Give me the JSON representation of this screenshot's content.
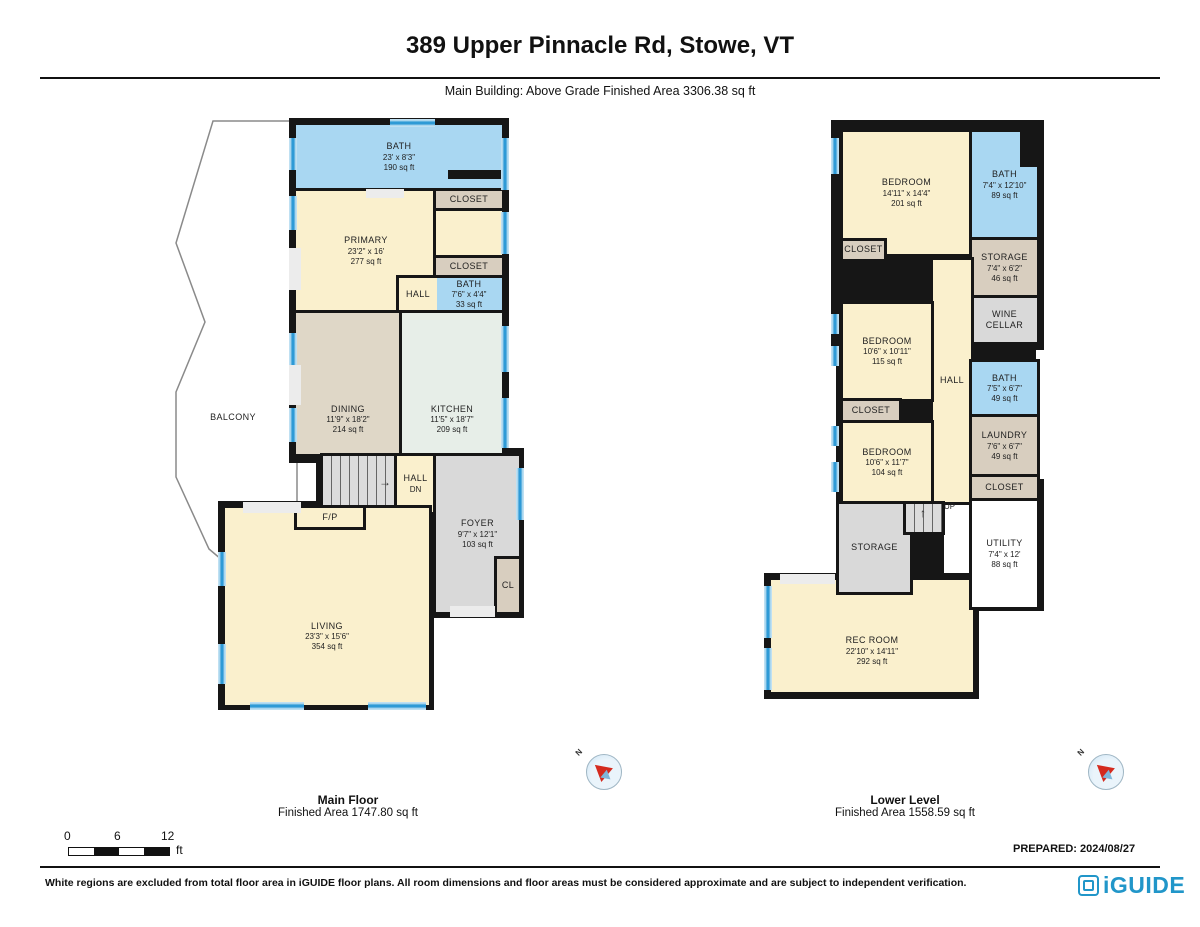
{
  "header": {
    "title": "389 Upper Pinnacle Rd, Stowe, VT",
    "subtitle": "Main Building: Above Grade Finished Area 3306.38 sq ft"
  },
  "floors": {
    "main": {
      "label": "Main Floor",
      "area_label": "Finished Area 1747.80 sq ft",
      "rooms": {
        "bath_top": {
          "name": "BATH",
          "dims": "23' x 8'3\"",
          "area": "190 sq ft"
        },
        "primary": {
          "name": "PRIMARY",
          "dims": "23'2\" x 16'",
          "area": "277 sq ft"
        },
        "closet1": {
          "name": "CLOSET"
        },
        "closet2": {
          "name": "CLOSET"
        },
        "bath_small": {
          "name": "BATH",
          "dims": "7'6\" x 4'4\"",
          "area": "33 sq ft"
        },
        "hall_upper": {
          "name": "HALL"
        },
        "dining": {
          "name": "DINING",
          "dims": "11'9\" x 18'2\"",
          "area": "214 sq ft"
        },
        "kitchen": {
          "name": "KITCHEN",
          "dims": "11'5\" x 18'7\"",
          "area": "209 sq ft"
        },
        "hall_lower": {
          "name": "HALL",
          "dims": "DN"
        },
        "foyer": {
          "name": "FOYER",
          "dims": "9'7\" x 12'1\"",
          "area": "103 sq ft"
        },
        "cl": {
          "name": "CL"
        },
        "fp": {
          "name": "F/P"
        },
        "living": {
          "name": "LIVING",
          "dims": "23'3\" x 15'6\"",
          "area": "354 sq ft"
        },
        "balcony": {
          "name": "BALCONY"
        }
      }
    },
    "lower": {
      "label": "Lower Level",
      "area_label": "Finished Area 1558.59 sq ft",
      "rooms": {
        "bedroom1": {
          "name": "BEDROOM",
          "dims": "14'11\" x 14'4\"",
          "area": "201 sq ft"
        },
        "bath1": {
          "name": "BATH",
          "dims": "7'4\" x 12'10\"",
          "area": "89 sq ft"
        },
        "closet_a": {
          "name": "CLOSET"
        },
        "storage1": {
          "name": "STORAGE",
          "dims": "7'4\" x 6'2\"",
          "area": "46 sq ft"
        },
        "wine": {
          "name": "WINE CELLAR"
        },
        "bedroom2": {
          "name": "BEDROOM",
          "dims": "10'6\" x 10'11\"",
          "area": "115 sq ft"
        },
        "hall": {
          "name": "HALL"
        },
        "bath2": {
          "name": "BATH",
          "dims": "7'5\" x 6'7\"",
          "area": "49 sq ft"
        },
        "closet_b": {
          "name": "CLOSET"
        },
        "bedroom3": {
          "name": "BEDROOM",
          "dims": "10'6\" x 11'7\"",
          "area": "104 sq ft"
        },
        "laundry": {
          "name": "LAUNDRY",
          "dims": "7'6\" x 6'7\"",
          "area": "49 sq ft"
        },
        "closet_c": {
          "name": "CLOSET"
        },
        "storage2": {
          "name": "STORAGE"
        },
        "up": {
          "name": "UP"
        },
        "utility": {
          "name": "UTILITY",
          "dims": "7'4\" x 12'",
          "area": "88 sq ft"
        },
        "recroom": {
          "name": "REC ROOM",
          "dims": "22'10\" x 14'11\"",
          "area": "292 sq ft"
        }
      }
    }
  },
  "compass": {
    "label": "N"
  },
  "scale_bar": {
    "ticks": [
      "0",
      "6",
      "12"
    ],
    "unit": "ft"
  },
  "prepared": "PREPARED: 2024/08/27",
  "footer": {
    "disclaimer": "White regions are excluded from total floor area in iGUIDE floor plans. All room dimensions and floor areas must be considered approximate and are subject to independent verification.",
    "brand": "iGUIDE"
  },
  "colors": {
    "wall": "#161616",
    "room_cream": "#FAF0CD",
    "room_blue": "#A9D7F2",
    "room_tan": "#DFD7C7",
    "room_green": "#E7EEE8",
    "room_gray": "#D9D9D9",
    "closet_tan": "#D8CEBF",
    "window_blue": "#2E9AD6",
    "brand_blue": "#2196C9"
  }
}
